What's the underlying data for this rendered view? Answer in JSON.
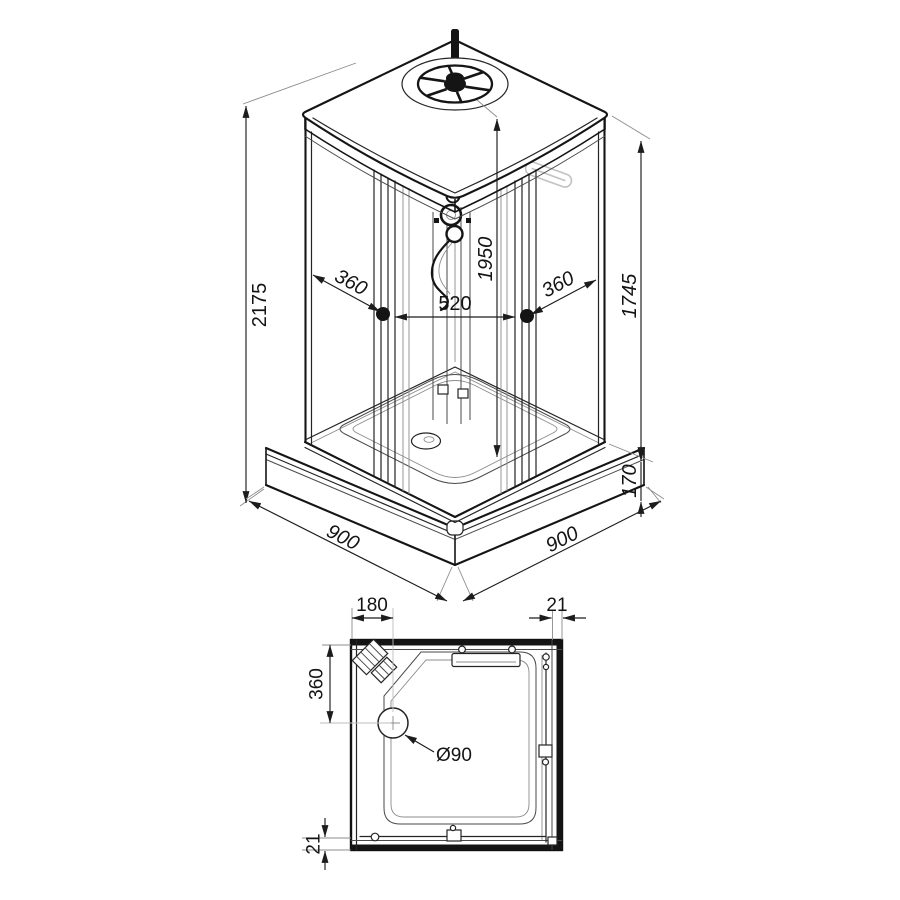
{
  "drawing": {
    "background": "#ffffff",
    "line_color": "#1a1a1a",
    "glass_detail_color": "#c2c2c2"
  },
  "isometric_view": {
    "dimensions": {
      "total_height": "2175",
      "left_fixed_panel": "360",
      "entry_opening": "520",
      "right_fixed_panel": "360",
      "inner_height": "1950",
      "side_glass_height": "1745",
      "tray_height": "170",
      "base_depth": "900",
      "base_width": "900"
    }
  },
  "plan_view": {
    "dimensions": {
      "drain_offset_x": "180",
      "wall_profile_top": "21",
      "drain_offset_y": "360",
      "drain_diameter": "Ø90",
      "wall_profile_bottom": "21"
    }
  }
}
